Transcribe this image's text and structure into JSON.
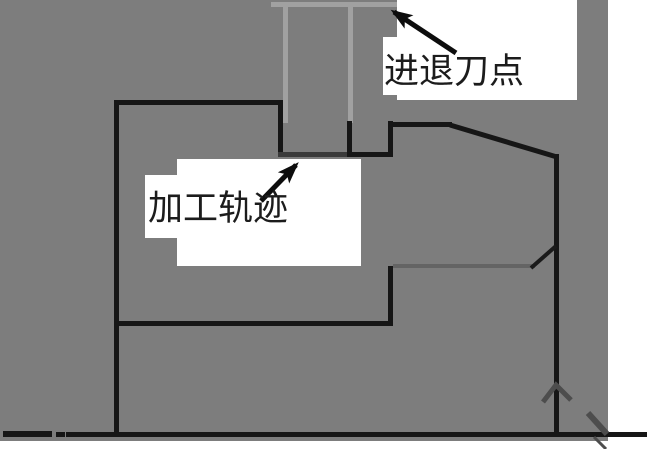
{
  "diagram": {
    "labels": {
      "entry_exit_point": "进退刀点",
      "machining_path": "加工轨迹"
    },
    "icons": {
      "entry_exit_arrow": "arrow-up-left",
      "machining_path_arrow": "arrow-up-right",
      "direction_mark": "chevron-up",
      "axis_end_mark": "diagonal-slash"
    },
    "colors": {
      "background": "#7d7d7d",
      "part_contour": "#161616",
      "entry_exit_path": "#a1a1a1",
      "secondary_pass_line": "#646464",
      "direction_marks": "#4d4d4d",
      "label_background": "#ffffff",
      "annotation_text": "#1c1c1c",
      "centerline": "#111111"
    }
  }
}
